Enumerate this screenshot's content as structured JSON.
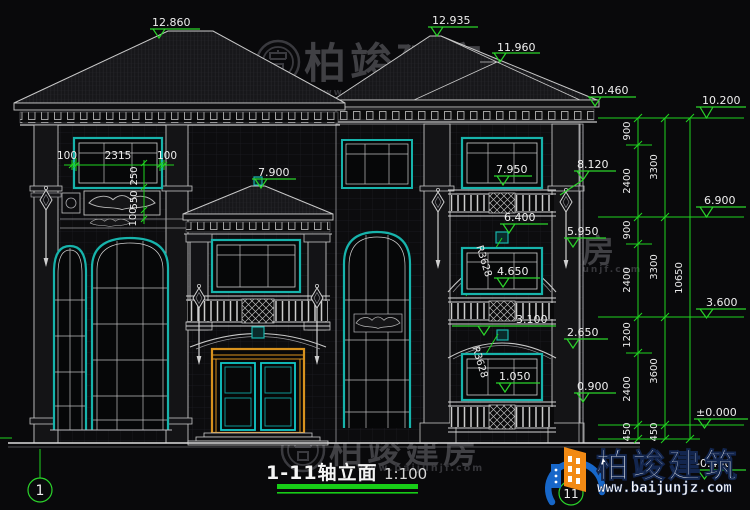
{
  "title_block": {
    "title": "1-11轴立面",
    "scale": "1:100"
  },
  "axis_markers": {
    "start": "1",
    "end": "11"
  },
  "elevation_marks": {
    "left_roof_ridge": "12.860",
    "porch_roof_ridge": "7.900",
    "right_roof_ridge": "12.935",
    "right_roof_hip": "11.960",
    "right_eave": "10.460",
    "pilaster_top": "8.120",
    "floor3_window": "7.950",
    "floor2_arch_top": "6.400",
    "floor2_arch_spring": "5.950",
    "floor2_window_sill": "4.650",
    "floor2_balcony": "3.100",
    "floor1_arch_spring": "2.650",
    "floor1_window_sill": "1.050",
    "floor1_balcony": "0.900",
    "level_top": "10.200",
    "level_floor3": "6.900",
    "level_floor2": "3.600",
    "level_ground": "±0.000",
    "level_basement": "-0.450"
  },
  "dimensions": {
    "window_margin_left": "100",
    "window_width": "2315",
    "window_margin_right": "100",
    "sill_offset": "250",
    "frieze_height": "550",
    "band_height": "100",
    "arch_radius_floor2": "R3628",
    "arch_radius_floor1": "R3628",
    "chain_inner": [
      "900",
      "2400",
      "900",
      "2400",
      "1200",
      "2400",
      "450"
    ],
    "chain_middle": [
      "3300",
      "3300",
      "3600",
      "450"
    ],
    "chain_total": "10650"
  },
  "watermark": {
    "brand": "柏竣建房",
    "url": "www.baijunjf.com"
  },
  "logo": {
    "brand": "柏竣建筑",
    "url": "www.baijunjz.com"
  }
}
